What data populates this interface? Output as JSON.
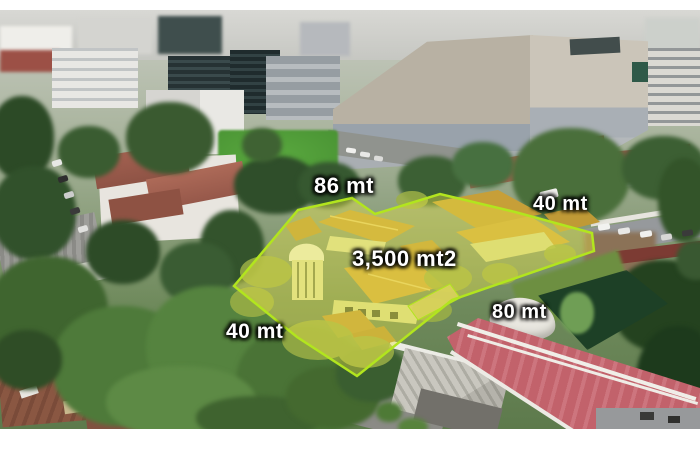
{
  "photo": {
    "description": "Aerial drone view of a city block with a highlighted corner lot for sale, surrounded by trees, houses, streets and office buildings"
  },
  "lot": {
    "area_label": "3,500 mt2",
    "sides": {
      "top": "86 mt",
      "right": "40 mt",
      "bottom_left": "40 mt",
      "bottom_right": "80 mt"
    },
    "outline_color": "#b2e51e",
    "fill_color": "#e9e446",
    "fill_opacity": "0.40"
  }
}
